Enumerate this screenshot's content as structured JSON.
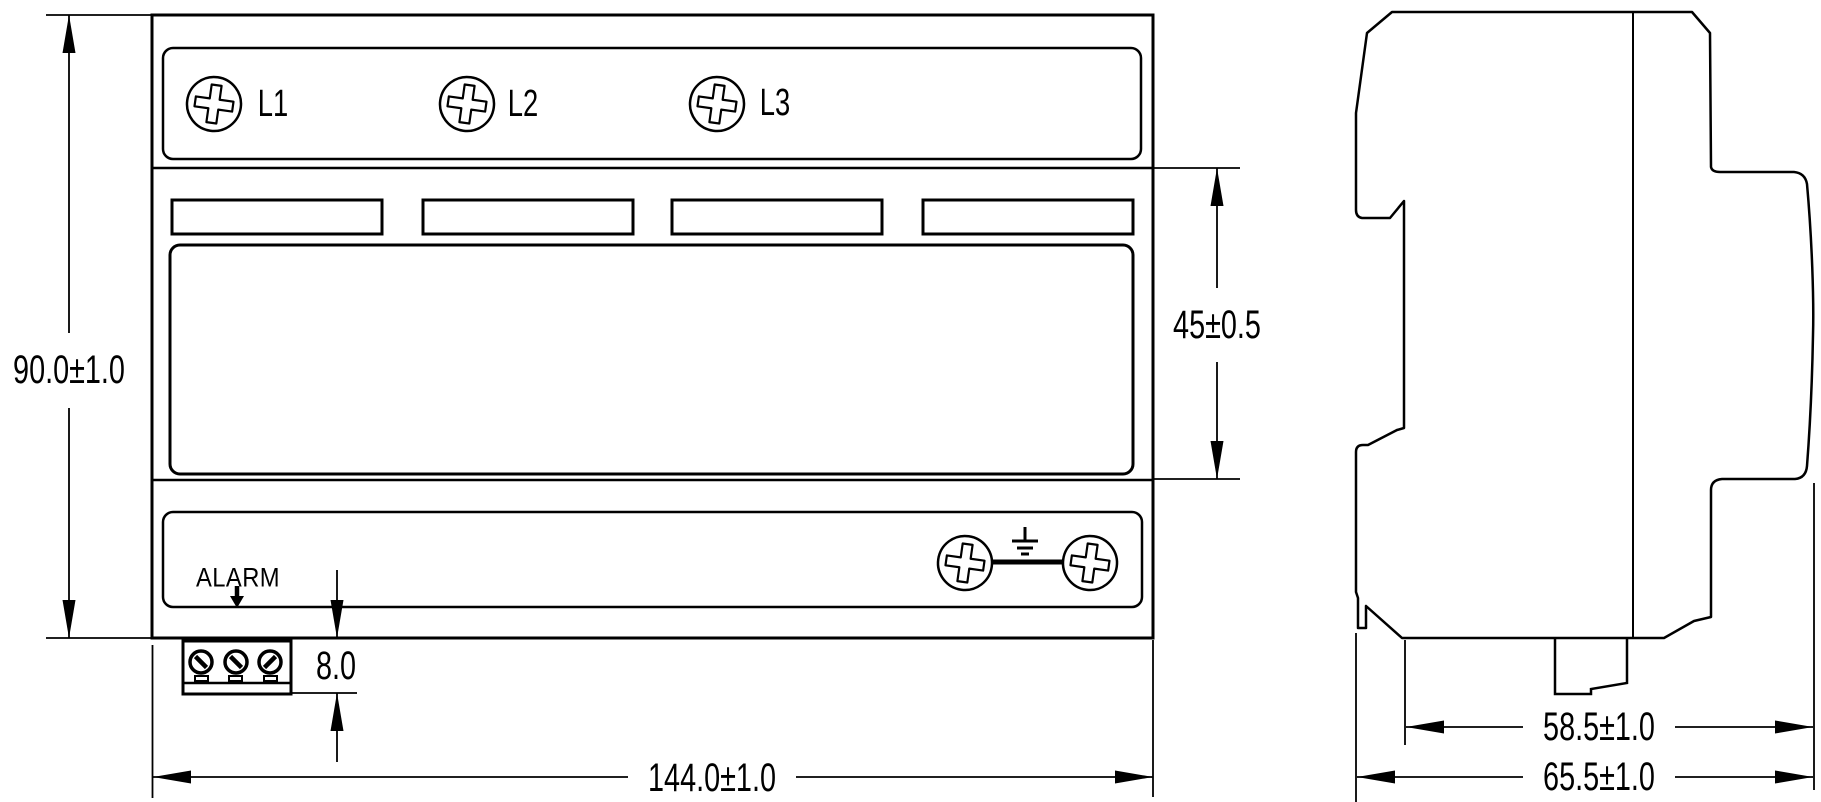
{
  "front_view": {
    "phase_labels": [
      "L1",
      "L2",
      "L3"
    ],
    "alarm_label": "ALARM"
  },
  "dimensions": {
    "overall_height": "90.0±1.0",
    "center_section_height": "45±0.5",
    "terminal_block_height": "8.0",
    "overall_width": "144.0±1.0",
    "body_depth": "58.5±1.0",
    "overall_depth": "65.5±1.0"
  },
  "colors": {
    "line": "#000000",
    "background": "#ffffff"
  },
  "icons": {
    "phillips_screw": "phillips-screw-icon",
    "slotted_screw": "slotted-screw-icon",
    "earth_ground": "earth-ground-icon",
    "alarm_arrow": "alarm-arrow-icon"
  }
}
